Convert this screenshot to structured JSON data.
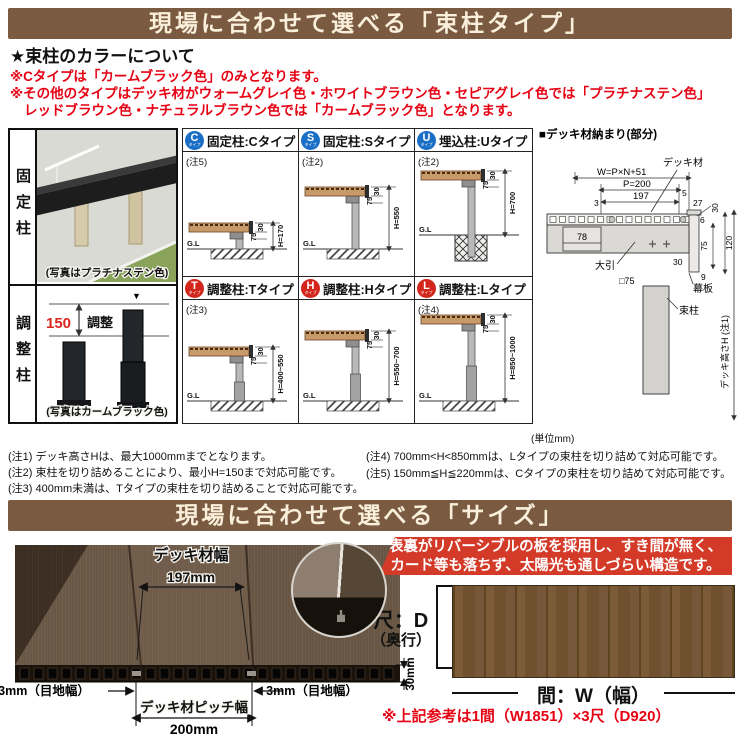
{
  "colors": {
    "banner_bg": "#7a5a41",
    "banner_text": "#f9efdb",
    "accent_red": "#e60012",
    "badge_blue": "#1b6ec6",
    "badge_red": "#d2261c",
    "feature_bg": "#d43a28",
    "deck_wood": "#c79a69",
    "plan_wood": "#6f5130"
  },
  "banner1": {
    "title": "現場に合わせて選べる「束柱タイプ」"
  },
  "color_section": {
    "heading": "★束柱のカラーについて",
    "line1": "※Cタイプは「カームブラック色」のみとなります。",
    "line2": "※その他のタイプはデッキ材がウォームグレイ色・ホワイトブラウン色・セピアグレイ色では「プラチナステン色」",
    "line3": "レッドブラウン色・ナチュラルブラウン色では「カームブラック色」となります。"
  },
  "left_panel": {
    "fixed_label": "固定柱",
    "fixed_caption": "(写真はプラチナステン色)",
    "adjust_label": "調整柱",
    "adjust_caption": "(写真はカームブラック色)",
    "adjust_dim": "150",
    "adjust_word": "調整"
  },
  "types": [
    {
      "letter": "C",
      "sub": "タイプ",
      "title": "固定柱:Cタイプ",
      "note": "(注5)",
      "d30": "30",
      "d75": "75",
      "dimH": "H=170",
      "gl": "G.L"
    },
    {
      "letter": "S",
      "sub": "タイプ",
      "title": "固定柱:Sタイプ",
      "note": "(注2)",
      "d30": "30",
      "d75": "75",
      "dimH": "H=550",
      "gl": "G.L"
    },
    {
      "letter": "U",
      "sub": "タイプ",
      "title": "埋込柱:Uタイプ",
      "note": "(注2)",
      "d30": "30",
      "d75": "75",
      "dimH": "H=700",
      "gl": "G.L"
    },
    {
      "letter": "T",
      "sub": "タイプ",
      "title": "調整柱:Tタイプ",
      "note": "(注3)",
      "d30": "30",
      "d75": "75",
      "dimH": "H=400~550",
      "gl": "G.L"
    },
    {
      "letter": "H",
      "sub": "タイプ",
      "title": "調整柱:Hタイプ",
      "note": "",
      "d30": "30",
      "d75": "75",
      "dimH": "H=550~700",
      "gl": "G.L"
    },
    {
      "letter": "L",
      "sub": "タイプ",
      "title": "調整柱:Lタイプ",
      "note": "(注4)",
      "d30": "30",
      "d75": "75",
      "dimH": "H=850~1000",
      "gl": "G.L"
    }
  ],
  "nosamari": {
    "title": "■デッキ材納まり(部分)",
    "deck_label": "デッキ材",
    "w_formula": "W=P×N+51",
    "p": "P=200",
    "d3": "3",
    "d197": "197",
    "d5": "5",
    "d27": "27",
    "d6": "6",
    "d30a": "30",
    "d120": "120",
    "d75": "75",
    "d9": "9",
    "d30b": "30",
    "d78": "78",
    "obiki": "大引",
    "sq75": "□75",
    "makaita": "幕板",
    "tsukabashira": "束柱",
    "height_label": "デッキ高さH (注1)"
  },
  "notes": {
    "left": [
      "(注1) デッキ高さHは、最大1000mmまでとなります。",
      "(注2) 束柱を切り詰めることにより、最小H=150まで対応可能です。",
      "(注3) 400mm未満は、Tタイプの束柱を切り詰めることで対応可能です。"
    ],
    "right": [
      "(注4) 700mm<H<850mmは、Lタイプの束柱を切り詰めて対応可能です。",
      "(注5) 150mm≦H≦220mmは、Cタイプの束柱を切り詰めて対応可能です。"
    ],
    "unit": "(単位mm)"
  },
  "banner2": {
    "title": "現場に合わせて選べる「サイズ」"
  },
  "size_section": {
    "deck_width_label": "デッキ材幅",
    "deck_width_value": "197mm",
    "joint_left": "3mm（目地幅）",
    "joint_right": "3mm（目地幅）",
    "pitch_label": "デッキ材ピッチ幅",
    "pitch_value": "200mm",
    "thickness": "30mm",
    "feature_line1": "表裏がリバーシブルの板を採用し、すき間が無く、",
    "feature_line2": "カード等も落ちず、太陽光も通しづらい構造です。",
    "depth_label": "尺：D",
    "depth_sub": "（奥行）",
    "width_label": "間：W（幅）",
    "reference": "※上記参考は1間（W1851）×3尺（D920）"
  }
}
